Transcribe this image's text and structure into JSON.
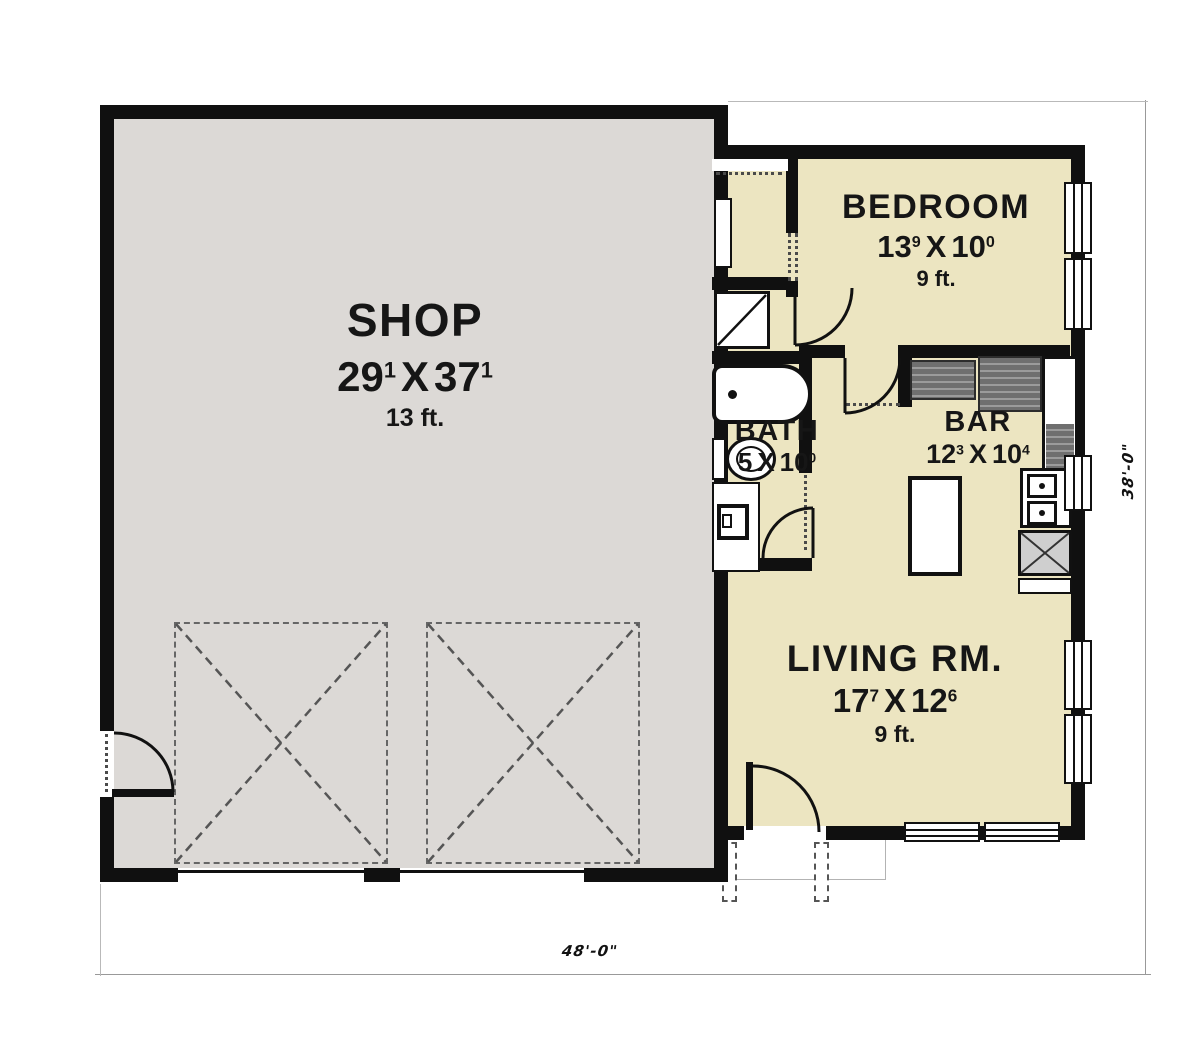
{
  "rooms": {
    "shop": {
      "name": "SHOP",
      "w": "29",
      "w_sup": "1",
      "sep": "X",
      "h": "37",
      "h_sup": "1",
      "ceiling": "13 ft."
    },
    "bedroom": {
      "name": "BEDROOM",
      "w": "13",
      "w_sup": "9",
      "sep": "X",
      "h": "10",
      "h_sup": "0",
      "ceiling": "9 ft."
    },
    "bath": {
      "name": "BATH",
      "w": "5",
      "w_sup": "",
      "sep": "X",
      "h": "10",
      "h_sup": "0"
    },
    "bar": {
      "name": "BAR",
      "w": "12",
      "w_sup": "3",
      "sep": "X",
      "h": "10",
      "h_sup": "4"
    },
    "living": {
      "name": "LIVING RM.",
      "w": "17",
      "w_sup": "7",
      "sep": "X",
      "h": "12",
      "h_sup": "6",
      "ceiling": "9 ft."
    }
  },
  "dimensions": {
    "overall_width": "48'-0\"",
    "overall_height": "38'-0\""
  },
  "colors": {
    "shop_fill": "#dcd9d6",
    "unit_fill": "#ece5c1",
    "wall": "#101010",
    "counter": "#6f6f6f",
    "dim_line": "#999999"
  }
}
